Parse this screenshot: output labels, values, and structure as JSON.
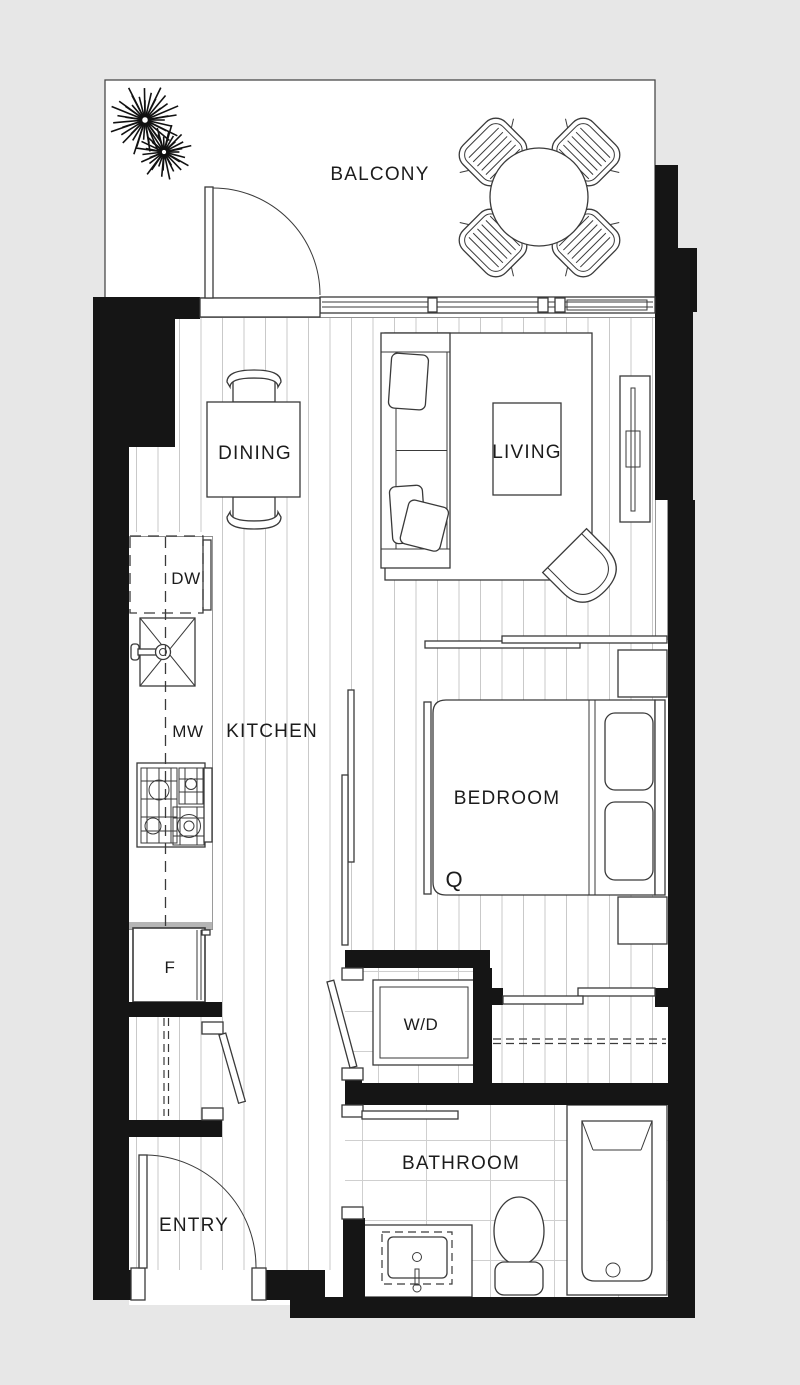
{
  "plan": {
    "title": "Apartment floor plan",
    "rooms": {
      "balcony": "BALCONY",
      "dining": "DINING",
      "living": "LIVING",
      "kitchen": "KITCHEN",
      "bedroom": "BEDROOM",
      "bathroom": "BATHROOM",
      "entry": "ENTRY"
    },
    "appliances": {
      "dishwasher": "DW",
      "microwave": "MW",
      "fridge": "F",
      "washer_dryer": "W/D"
    },
    "bed_size": "Q",
    "colors": {
      "background": "#e7e7e7",
      "wall": "#151515",
      "line": "#3a3a3a",
      "floor_line": "#c9c9c9",
      "tile_line": "#cfcfcf",
      "text": "#1c1c1c"
    }
  }
}
